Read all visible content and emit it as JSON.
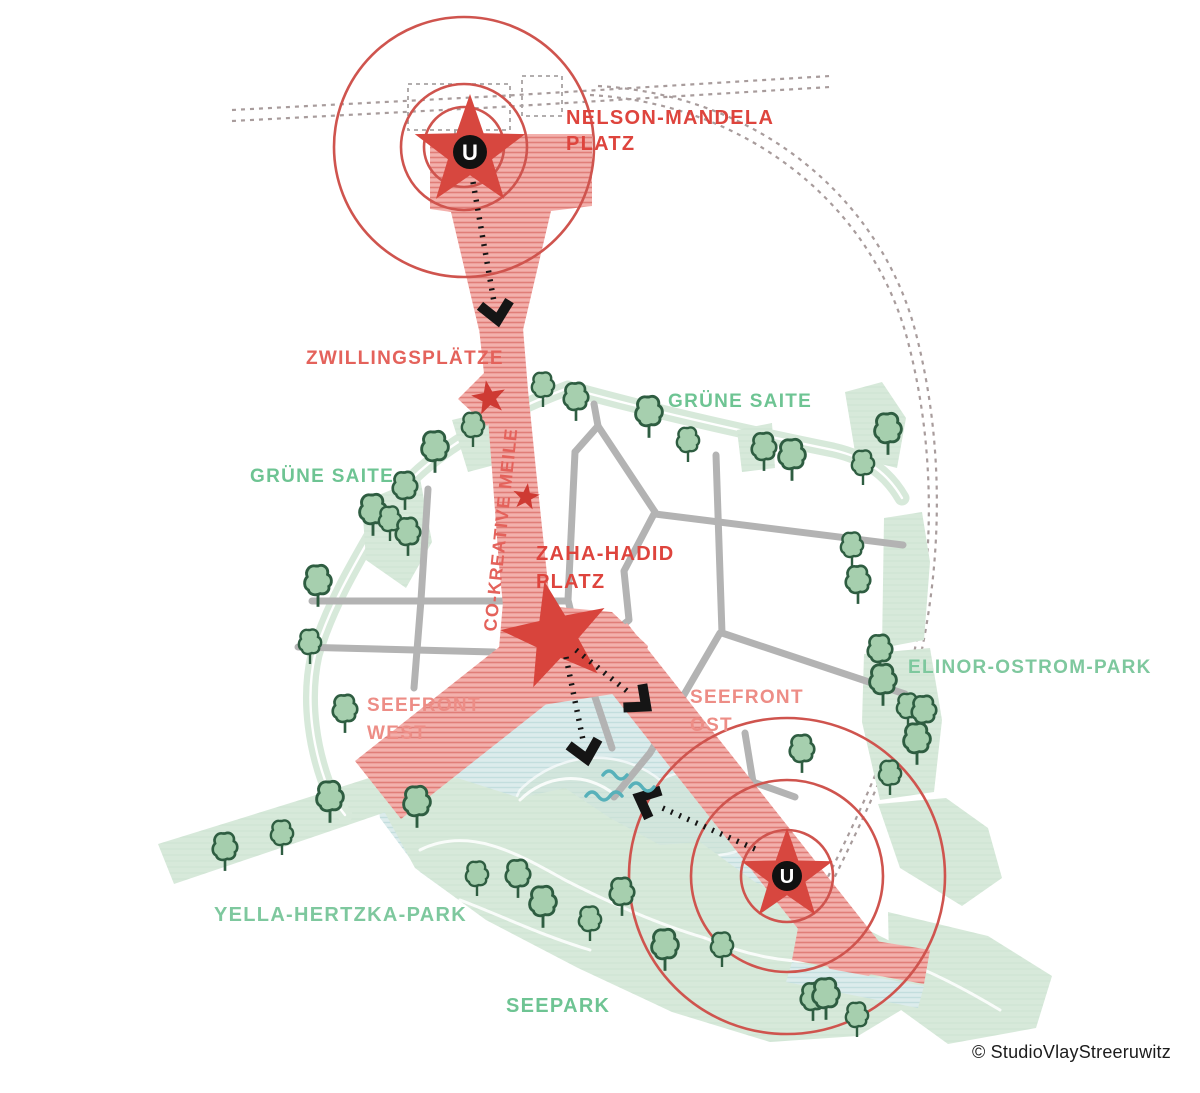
{
  "map": {
    "copyright": "© StudioVlayStreeruwitz",
    "labels": {
      "nelson_mandela": {
        "line1": "NELSON-MANDELA",
        "line2": "PLATZ"
      },
      "zwillingsplaetze": "ZWILLINGSPLÄTZE",
      "gruene_saite_west": "GRÜNE SAITE",
      "gruene_saite_ost": "GRÜNE SAITE",
      "co_kreative_meile": "CO-KREATIVE MEILE",
      "zaha_hadid": {
        "line1": "ZAHA-HADID",
        "line2": "PLATZ"
      },
      "seefront_west": {
        "line1": "SEEFRONT",
        "line2": "WEST"
      },
      "seefront_ost": {
        "line1": "SEEFRONT",
        "line2": "OST"
      },
      "elinor_ostrom_park": "ELINOR-OSTROM-PARK",
      "yella_hertzka_park": "YELLA-HERTZKA-PARK",
      "seepark": "SEEPARK"
    },
    "stations": {
      "u_label": "U"
    },
    "icons": {
      "station": "u-bahn-station-icon",
      "plaza": "star-plaza-icon",
      "tree": "tree-icon",
      "arrow": "flow-arrow-icon",
      "wave": "water-wave-icon"
    },
    "colors": {
      "label_red": "#de443d",
      "label_red_mid": "#e4625b",
      "label_red_light": "#ed8d86",
      "label_green": "#6ec493",
      "label_green_light": "#7ec89e",
      "corridor_pink": "#f3b0ac",
      "corridor_stripe": "#e07d78",
      "star_red": "#d7473f",
      "circle_red": "#cf544e",
      "lake_blue": "#dcecec",
      "lake_stripe": "#c3dede",
      "park_green": "#d7e9da",
      "tree_fill": "#a6cfae",
      "tree_stroke": "#2e5d41",
      "road_gray": "#b3b3b3",
      "rail_dash": "#a89c9c",
      "arrow_black": "#151515",
      "wave_teal": "#57b1ba",
      "copyright_color": "#1c1c1c"
    }
  }
}
